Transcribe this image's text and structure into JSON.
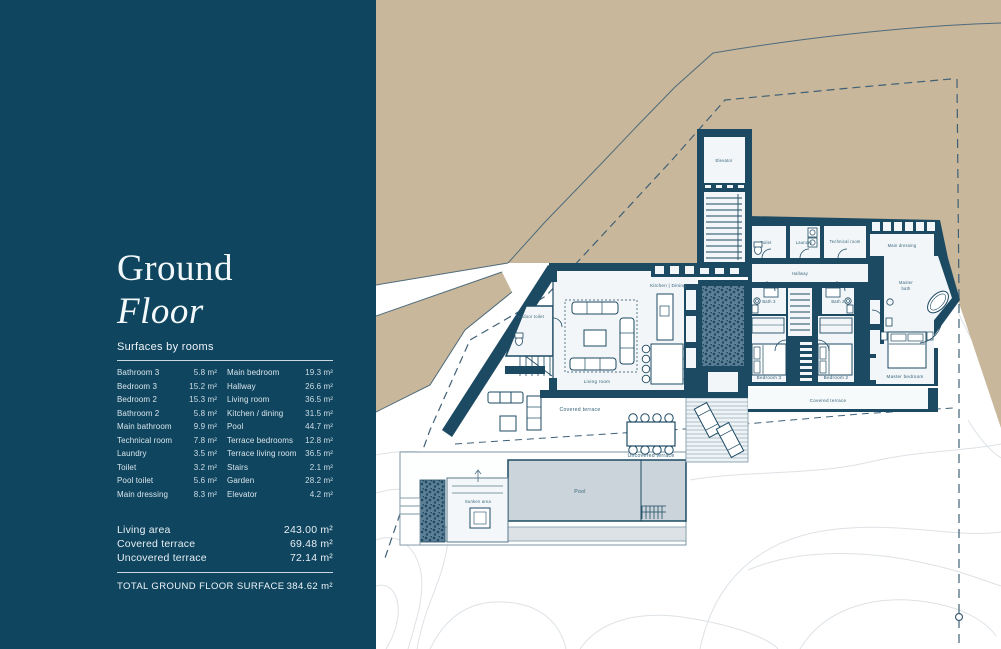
{
  "sidebar": {
    "title_line1": "Ground",
    "title_line2": "Floor",
    "surfaces_heading": "Surfaces by rooms",
    "rooms_left": [
      {
        "name": "Bathroom 3",
        "area": "5.8 m²"
      },
      {
        "name": "Bedroom 3",
        "area": "15.2 m²"
      },
      {
        "name": "Bedroom 2",
        "area": "15.3 m²"
      },
      {
        "name": "Bathroom 2",
        "area": "5.8 m²"
      },
      {
        "name": "Main bathroom",
        "area": "9.9 m²"
      },
      {
        "name": "Technical room",
        "area": "7.8 m²"
      },
      {
        "name": "Laundry",
        "area": "3.5 m²"
      },
      {
        "name": "Toilet",
        "area": "3.2 m²"
      },
      {
        "name": "Pool toilet",
        "area": "5.6 m²"
      },
      {
        "name": "Main dressing",
        "area": "8.3 m²"
      }
    ],
    "rooms_right": [
      {
        "name": "Main bedroom",
        "area": "19.3 m²"
      },
      {
        "name": "Hallway",
        "area": "26.6 m²"
      },
      {
        "name": "Living room",
        "area": "36.5 m²"
      },
      {
        "name": "Kitchen / dining",
        "area": "31.5 m²"
      },
      {
        "name": "Pool",
        "area": "44.7 m²"
      },
      {
        "name": "Terrace bedrooms",
        "area": "12.8 m²"
      },
      {
        "name": "Terrace living room",
        "area": "36.5 m²"
      },
      {
        "name": "Stairs",
        "area": "2.1 m²"
      },
      {
        "name": "Garden",
        "area": "28.2 m²"
      },
      {
        "name": "Elevator",
        "area": "4.2 m²"
      }
    ],
    "summary": [
      {
        "name": "Living area",
        "area": "243.00 m²"
      },
      {
        "name": "Covered terrace",
        "area": "69.48 m²"
      },
      {
        "name": "Uncovered terrace",
        "area": "72.14 m²"
      }
    ],
    "total_label": "TOTAL GROUND FLOOR SURFACE",
    "total_area": "384.62 m²"
  },
  "plan": {
    "labels": {
      "elevator": "Elevator",
      "kitchen_dining": "Kitchen | Dining",
      "living_room": "Living room",
      "outdoor_toilet": "Outdoor toilet",
      "covered_terrace_left": "Covered terrace",
      "covered_terrace_right": "Covered terrace",
      "uncovered_terrace": "Uncovered terrace",
      "pool": "Pool",
      "sunken_area": "Sunken area",
      "toilet": "Toilet",
      "laundry": "Laundry",
      "technical_room": "Technical room",
      "main_dressing": "Main dressing",
      "hallway": "Hallway",
      "bath_3": "Bath 3",
      "bath_2": "Bath 2",
      "master_bath_line1": "Master",
      "master_bath_line2": "bath",
      "bedroom_3": "Bedroom 3",
      "bedroom_2": "Bedroom 2",
      "master_bedroom": "Master bedroom"
    },
    "colors": {
      "panel_bg": "#0f455e",
      "terrain_tan": "#c8b79a",
      "wall": "#1d4a63",
      "pool_water": "#cbd4da"
    }
  }
}
